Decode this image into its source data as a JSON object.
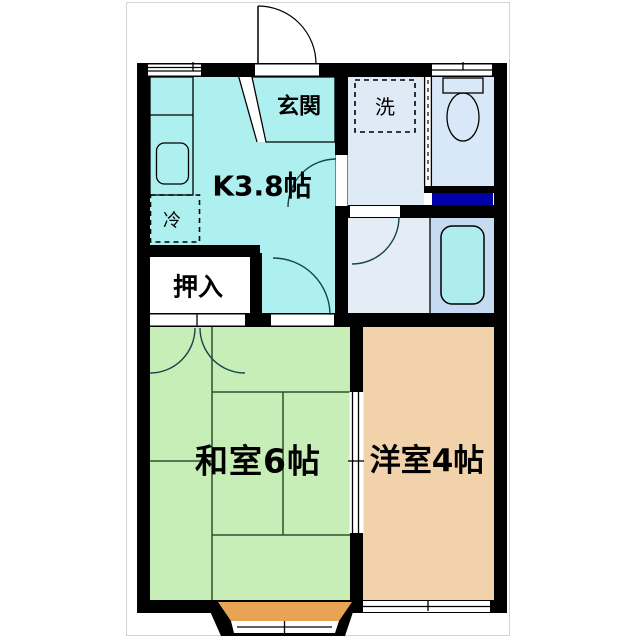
{
  "floor_plan": {
    "labels": {
      "kitchen": "K3.8帖",
      "entrance": "玄関",
      "laundry": "洗",
      "refrigerator": "冷",
      "closet": "押入",
      "japanese_room": "和室6帖",
      "western_room": "洋室4帖"
    },
    "colors": {
      "wall": "#000000",
      "kitchen": "#aef0f0",
      "counter": "#bdd8f3",
      "sink": "#cfe3f8",
      "entrance": "#d9d9d9",
      "washroom": "#dfeaf7",
      "laundry_box": "#e7f0fa",
      "toilet_room": "#d8e8f8",
      "fixture": "#cfe0f5",
      "shelf_navy": "#0000a8",
      "bath_floor": "#e4ecf6",
      "bath_area": "#c6dbf2",
      "bathtub": "#aeeced",
      "japanese_room": "#c6eeb6",
      "western_room": "#f2d2ab",
      "bay_window": "#e8a455"
    }
  }
}
